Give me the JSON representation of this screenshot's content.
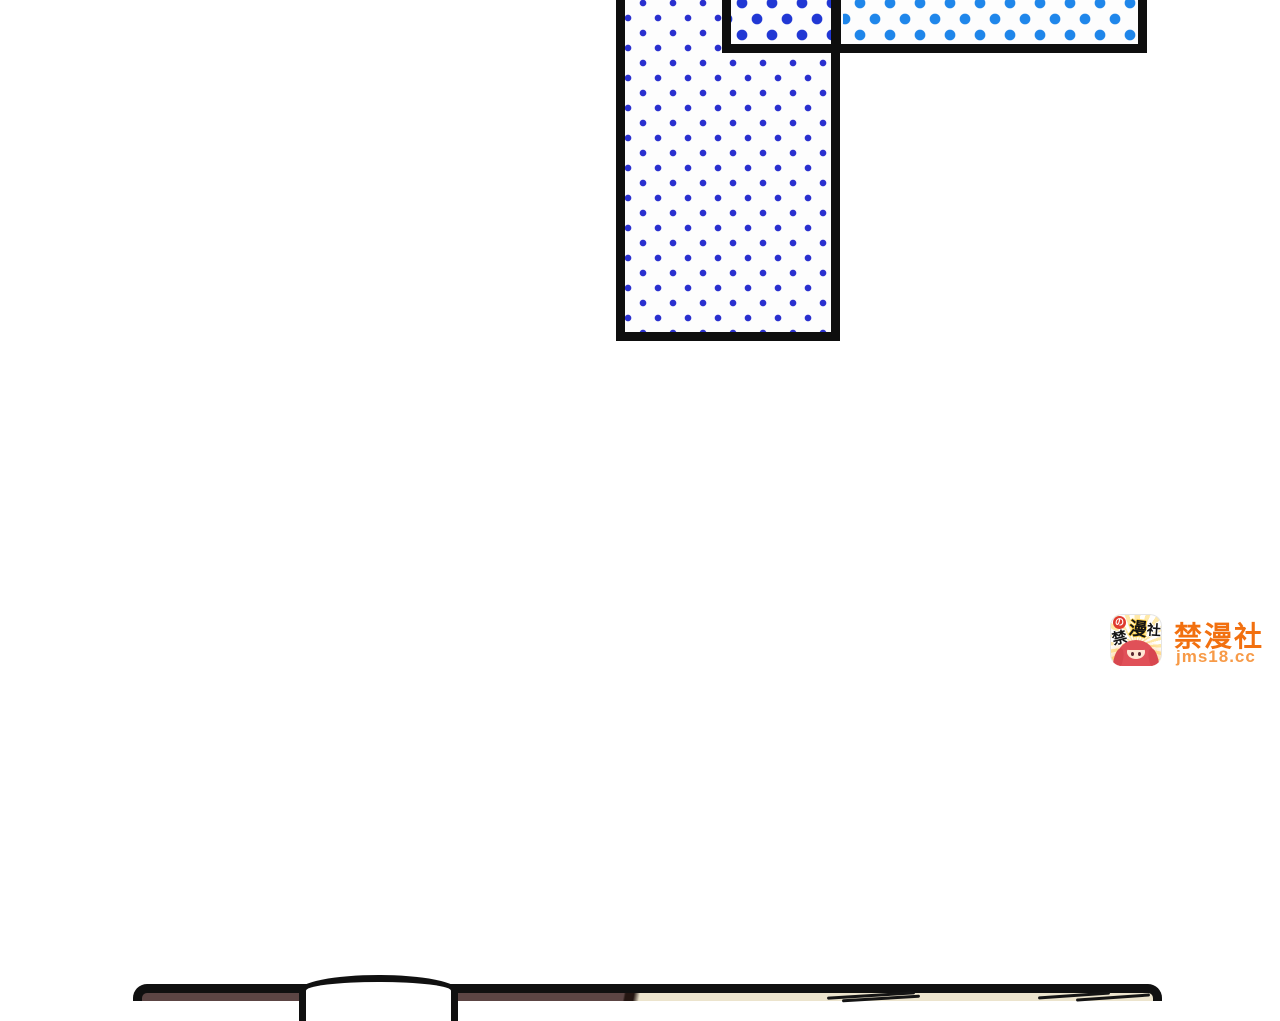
{
  "page": {
    "background_color": "#ffffff"
  },
  "panels": {
    "tall_halftone": {
      "dot_color": "#2a30cf",
      "fill": "#fdfdfd",
      "border_color": "#0e0e0e"
    },
    "strip_halftone": {
      "dot_color_left": "#2138d4",
      "dot_color_right": "#1f86ea",
      "fill": "#fdfdfd",
      "border_color": "#0e0e0e"
    },
    "bottom_edge": {
      "left_fill": "#5c4544",
      "right_fill": "#ece4cd",
      "dome_fill": "#ffffff",
      "border_color": "#101010"
    }
  },
  "watermark": {
    "site_name": "禁漫社",
    "site_url": "jms18.cc",
    "name_color": "#f2700f",
    "url_color": "#f79a47",
    "icon": {
      "chars": [
        "禁",
        "漫",
        "社"
      ],
      "badge_char": "の",
      "badge_color": "#e03a2e",
      "hair_color": "#e05058"
    }
  }
}
